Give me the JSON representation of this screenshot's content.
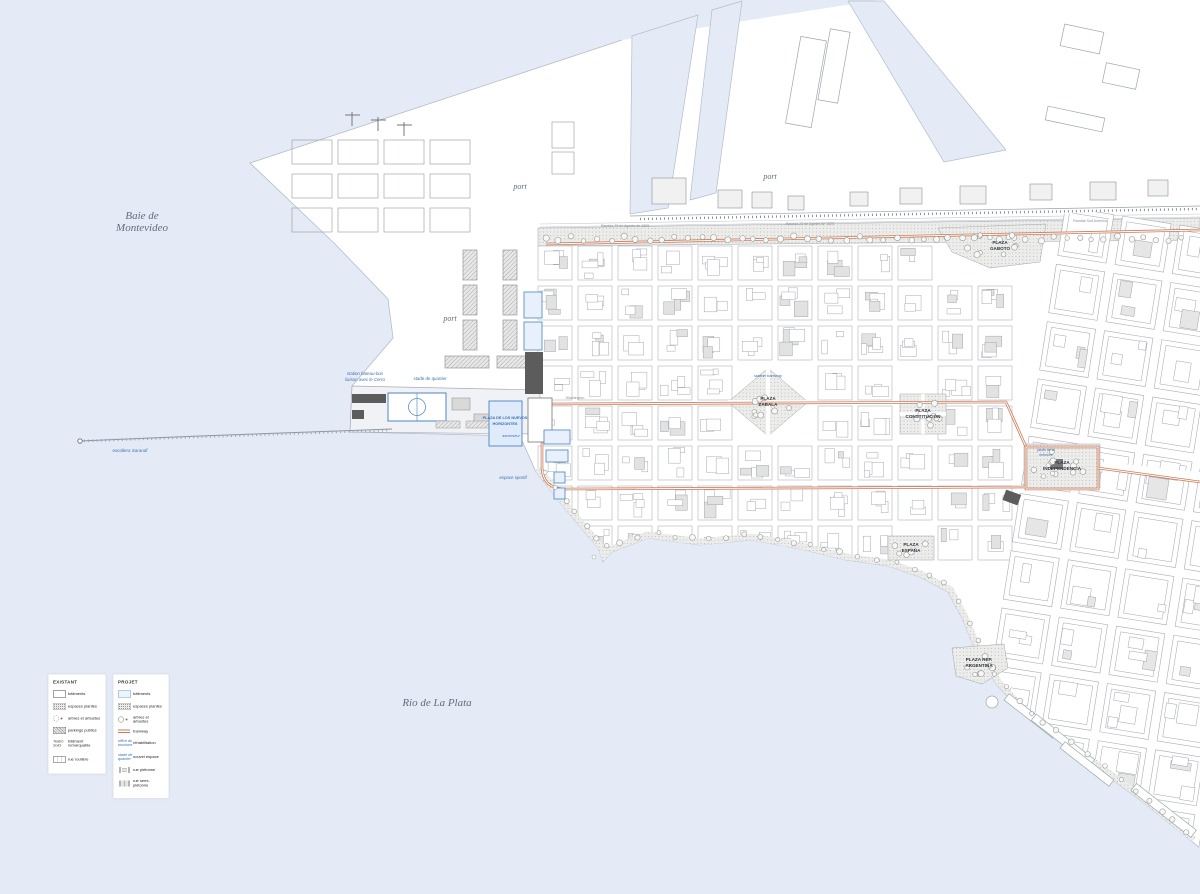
{
  "colors": {
    "water": "#e5ebf6",
    "land": "#ffffff",
    "tram": "#cc7a58",
    "projet_stroke": "#5b8fc9",
    "projet_fill": "#e8f1fb",
    "projet_text": "#3a6fb5",
    "dark_building": "#5c5c5c",
    "water_label": "#5f6e80",
    "green_fill": "#ececea",
    "tree_stroke": "#9a9a9a",
    "block_outline": "#a8adb5"
  },
  "water_labels": {
    "baie_line1": "Baie de",
    "baie_line2": "Montevideo",
    "rio": "Rio de La Plata"
  },
  "port_labels": {
    "p1": "port",
    "p2": "port",
    "p3": "port"
  },
  "plazas": {
    "zabala_l1": "PLAZA",
    "zabala_l2": "ZABALA",
    "constitucion_l1": "PLAZA",
    "constitucion_l2": "CONSTITUCIÓN",
    "independencia_l1": "PLAZA",
    "independencia_l2": "INDEPENDENCIA",
    "espana_l1": "PLAZA",
    "espana_l2": "ESPAÑA",
    "argentina_l1": "PLAZA REP.",
    "argentina_l2": "ARGENTINA",
    "gaboto_l1": "PLAZA",
    "gaboto_l2": "GABOTO",
    "horizontes_l1": "PLAZA DE LOS NUEVOS",
    "horizontes_l2": "HORIZONTES"
  },
  "project_labels": {
    "station_bateau_l1": "station bateau-bus",
    "station_bateau_l2": "liaison avec le Cerro",
    "stade": "stade de quartier",
    "espace_sportif": "espace sportif",
    "station_tramway": "station tramway",
    "jardin_l1": "jardin de la",
    "jardin_l2": "mémoire",
    "ascenseur": "ascenseur",
    "escollera": "escollera Sarandí"
  },
  "street_labels": {
    "rambla_agosto": "Rambla 25 de Agosto de 1825",
    "rambla_sud": "Rambla Sud América",
    "washington": "Washington"
  },
  "legend_existant": {
    "title": "EXISTANT",
    "items": {
      "batiments": "bâtiments",
      "espaces": "espaces plantés",
      "arbres": "arbres et arbustes",
      "parkings": "parkings publics",
      "remarquable": "bâtiment remarquable",
      "remarquable_sample": "Teatro Solís",
      "rue": "rue routière"
    }
  },
  "legend_projet": {
    "title": "PROJET",
    "items": {
      "batiments": "bâtiments",
      "espaces": "espaces plantés",
      "arbres": "arbres et arbustes",
      "tramway": "tramway",
      "rehabilitation": "réhabilitation",
      "rehab_sample_l1": "office du",
      "rehab_sample_l2": "tourisme",
      "nouvel": "nouvel espace",
      "nouvel_sample_l1": "stade de",
      "nouvel_sample_l2": "quartier",
      "pietonne": "rue piétonne",
      "semi": "rue semi-piétonne"
    }
  }
}
